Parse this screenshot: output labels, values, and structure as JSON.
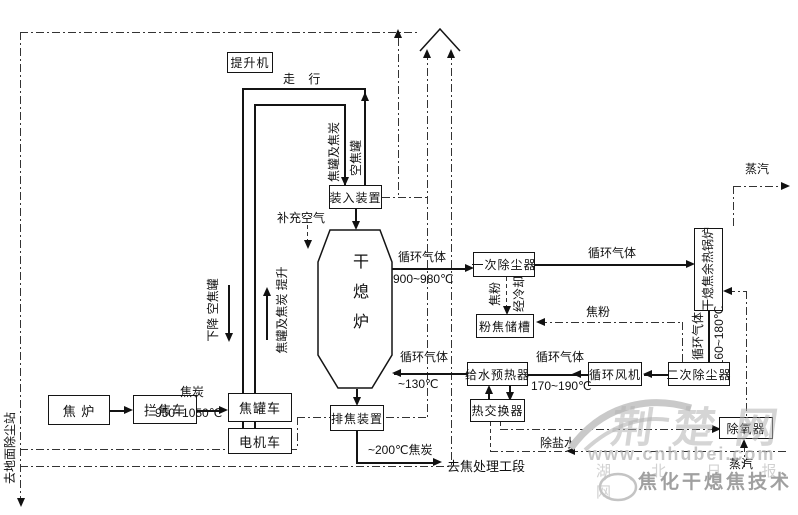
{
  "diagram": {
    "equipment": {
      "hoist": "提升机",
      "coke_oven": "焦 炉",
      "coke_guide_car": "拦焦车",
      "coke_tank_car": "焦罐车",
      "electric_locomotive": "电机车",
      "charging_device": "装入装置",
      "dry_quenching_furnace": "干熄炉",
      "coke_discharge_device": "排焦装置",
      "primary_dust_collector": "一次除尘器",
      "coke_powder_tank": "粉焦储槽",
      "waste_heat_boiler": "干熄焦余热锅炉",
      "secondary_dust_collector": "二次除尘器",
      "circulation_fan": "循环风机",
      "feedwater_preheater": "给水预热器",
      "heat_exchanger": "热交换器",
      "deaerator": "除氧器"
    },
    "flows": {
      "travel": "走 行",
      "descend_empty_tank": "下降  空焦罐",
      "lift_tank_and_coke": "焦罐及焦炭  提升",
      "tank_and_coke": "焦罐及焦炭",
      "empty_tank": "空焦罐",
      "supplementary_air": "补充空气",
      "coke": "焦炭",
      "coke_temp": "950~1050℃",
      "circulating_gas": "循环气体",
      "gas_temp_hot": "900~980℃",
      "gas_temp_boiler_out": "160~180℃",
      "gas_temp_fan": "170~190℃",
      "gas_temp_return": "~130℃",
      "coke_powder": "焦粉",
      "after_cooling": "经冷却",
      "steam": "蒸汽",
      "demineralized_water": "除盐水",
      "coke_out": "~200℃焦炭",
      "to_coke_processing": "去焦处理工段",
      "to_ground_dust_station": "去地面除尘站"
    }
  },
  "watermark": {
    "site": "荆楚网",
    "url": "www.cnhubei.com",
    "newspaper": "湖 北 日 报 网",
    "caption": "焦化干熄焦技术"
  }
}
